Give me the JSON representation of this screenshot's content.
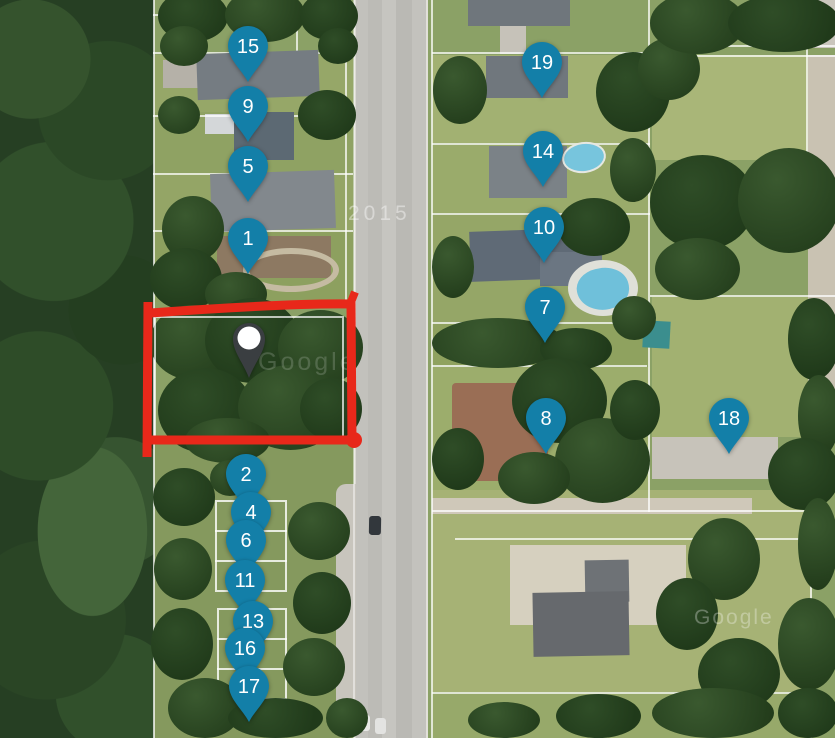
{
  "map": {
    "watermarks": {
      "year": "2015",
      "brand_mid": "Google",
      "brand_bottom": "Google"
    },
    "colors": {
      "pin": "#137fa8",
      "pin_text": "#ffffff",
      "selected_pin_body": "#3a3e41",
      "selected_pin_dot": "#ffffff",
      "highlight_rectangle": "#e8281a"
    },
    "selected_marker": {
      "x": 249,
      "y": 338
    },
    "markers": [
      {
        "label": "15",
        "x": 248,
        "y": 46
      },
      {
        "label": "9",
        "x": 248,
        "y": 106
      },
      {
        "label": "5",
        "x": 248,
        "y": 166
      },
      {
        "label": "1",
        "x": 248,
        "y": 238
      },
      {
        "label": "19",
        "x": 542,
        "y": 62
      },
      {
        "label": "14",
        "x": 543,
        "y": 151
      },
      {
        "label": "10",
        "x": 544,
        "y": 227
      },
      {
        "label": "7",
        "x": 545,
        "y": 307
      },
      {
        "label": "8",
        "x": 546,
        "y": 418
      },
      {
        "label": "18",
        "x": 729,
        "y": 418
      },
      {
        "label": "2",
        "x": 246,
        "y": 474
      },
      {
        "label": "4",
        "x": 251,
        "y": 512
      },
      {
        "label": "6",
        "x": 246,
        "y": 540
      },
      {
        "label": "11",
        "x": 245,
        "y": 580
      },
      {
        "label": "13",
        "x": 253,
        "y": 621
      },
      {
        "label": "16",
        "x": 245,
        "y": 648
      },
      {
        "label": "17",
        "x": 249,
        "y": 686
      }
    ]
  }
}
